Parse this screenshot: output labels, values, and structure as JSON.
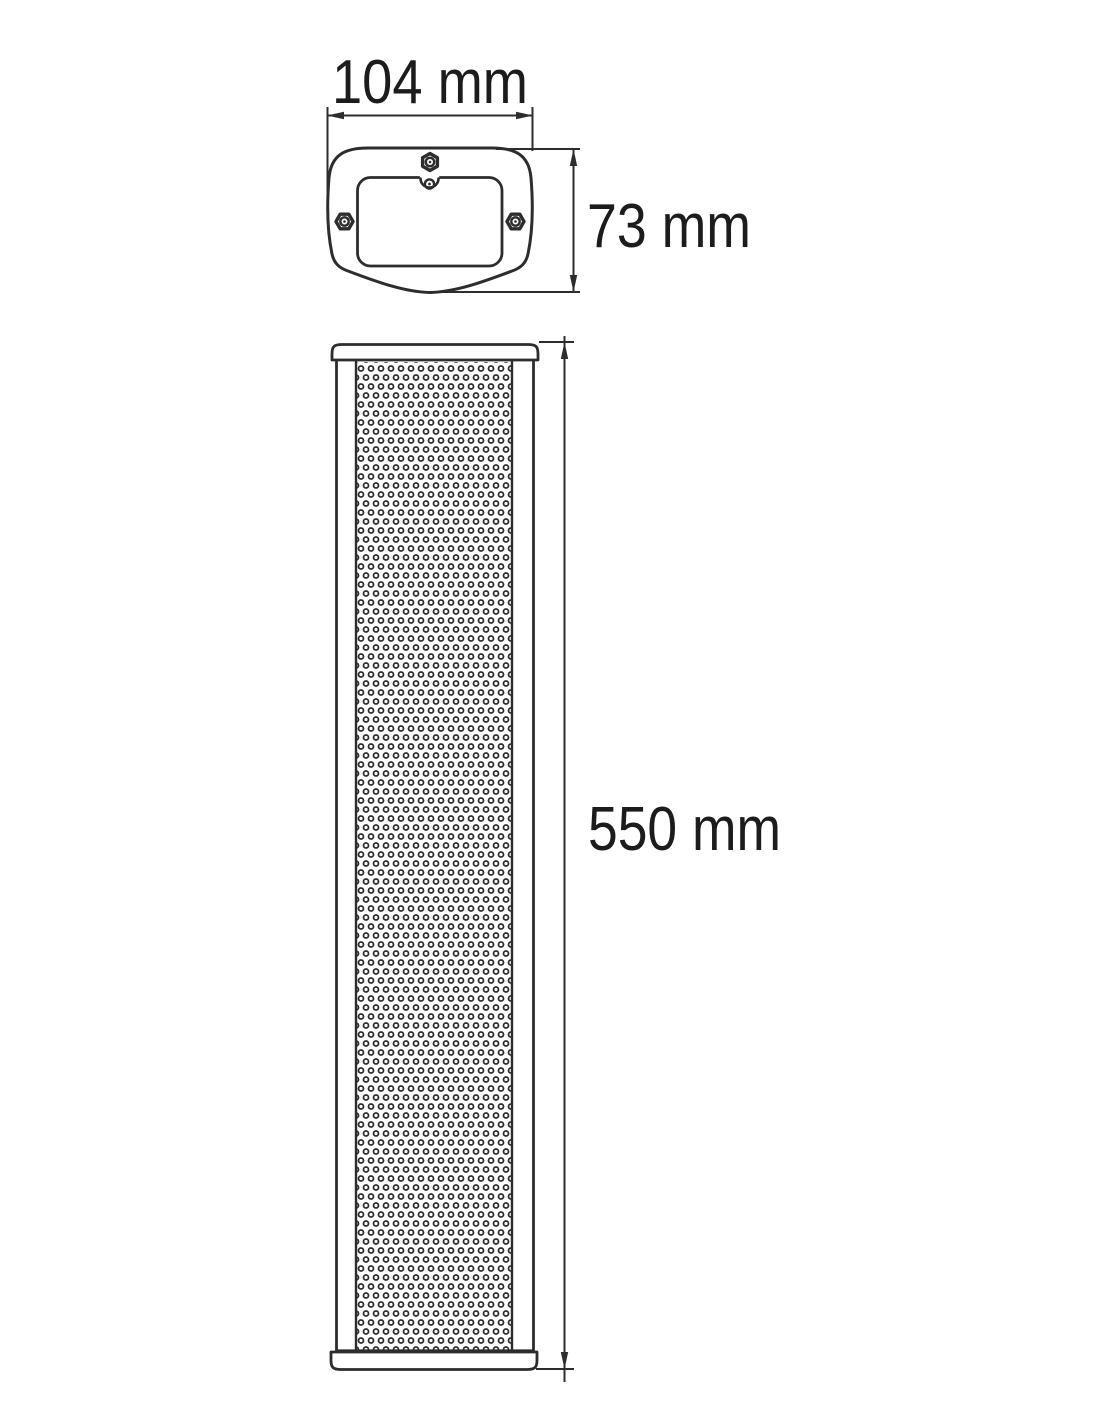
{
  "page": {
    "background_color": "#ffffff"
  },
  "drawing": {
    "kind": "technical dimension drawing",
    "subject": "column loudspeaker, top view and front view",
    "line_color": "#2d2d2d",
    "text_color": "#1c1c1c",
    "labels": {
      "top_width": "104 mm",
      "top_depth": "73 mm",
      "front_height": "550 mm"
    }
  }
}
